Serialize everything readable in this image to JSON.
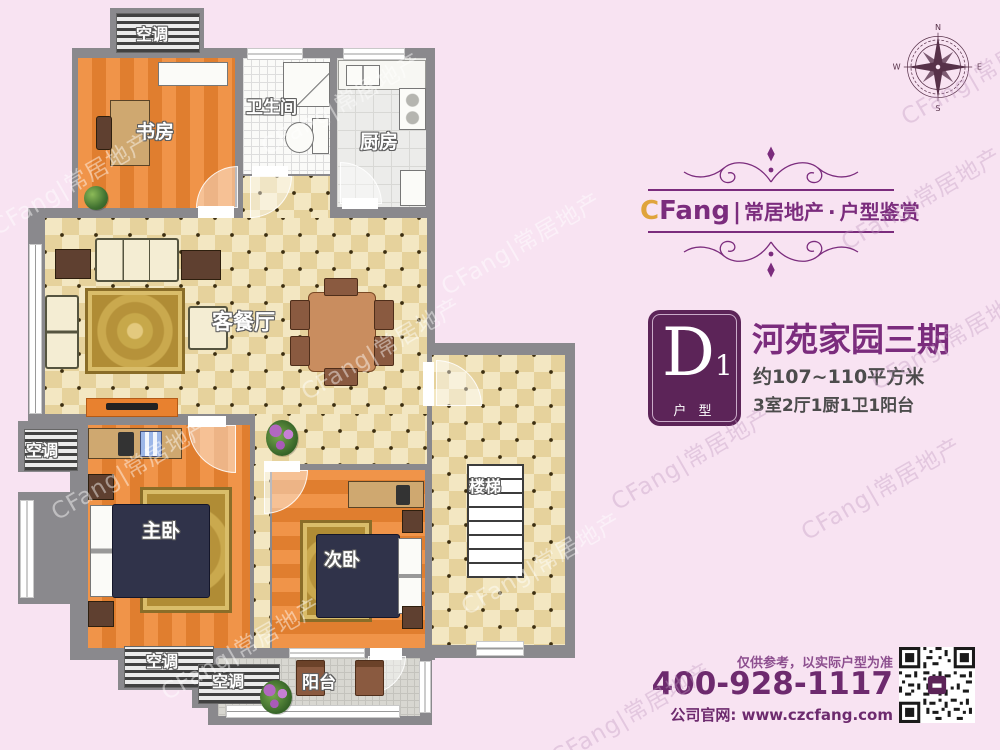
{
  "watermark": {
    "text": "CFang|常居地产"
  },
  "compass": {
    "n": "N",
    "e": "E",
    "s": "S",
    "w": "W"
  },
  "brand": {
    "logo_c": "C",
    "logo_fang": "Fang",
    "divider": "|",
    "company": "常居地产",
    "middot": "·",
    "series": "户型鉴赏"
  },
  "unit": {
    "badge_letter": "D",
    "badge_number": "1",
    "badge_caption": "户 型",
    "title": "河苑家园三期",
    "area": "约107~110平方米",
    "rooms_summary": "3室2厅1厨1卫1阳台"
  },
  "contact": {
    "disclaimer": "仅供参考，以实际户型为准",
    "phone": "400-928-1117",
    "website": "公司官网: www.czcfang.com"
  },
  "plan": {
    "labels": {
      "ac": "空调",
      "study": "书房",
      "bathroom": "卫生间",
      "kitchen": "厨房",
      "living_dining": "客餐厅",
      "master_bedroom": "主卧",
      "second_bedroom": "次卧",
      "stairs": "楼梯",
      "balcony": "阳台"
    }
  },
  "colors": {
    "background": "#f8e3f2",
    "brand_purple": "#7b2c7d",
    "badge_purple": "#5c2458",
    "accent_gold": "#e0a43c",
    "wall_grey": "#8a898d",
    "phone_purple": "#6d2a6e"
  }
}
